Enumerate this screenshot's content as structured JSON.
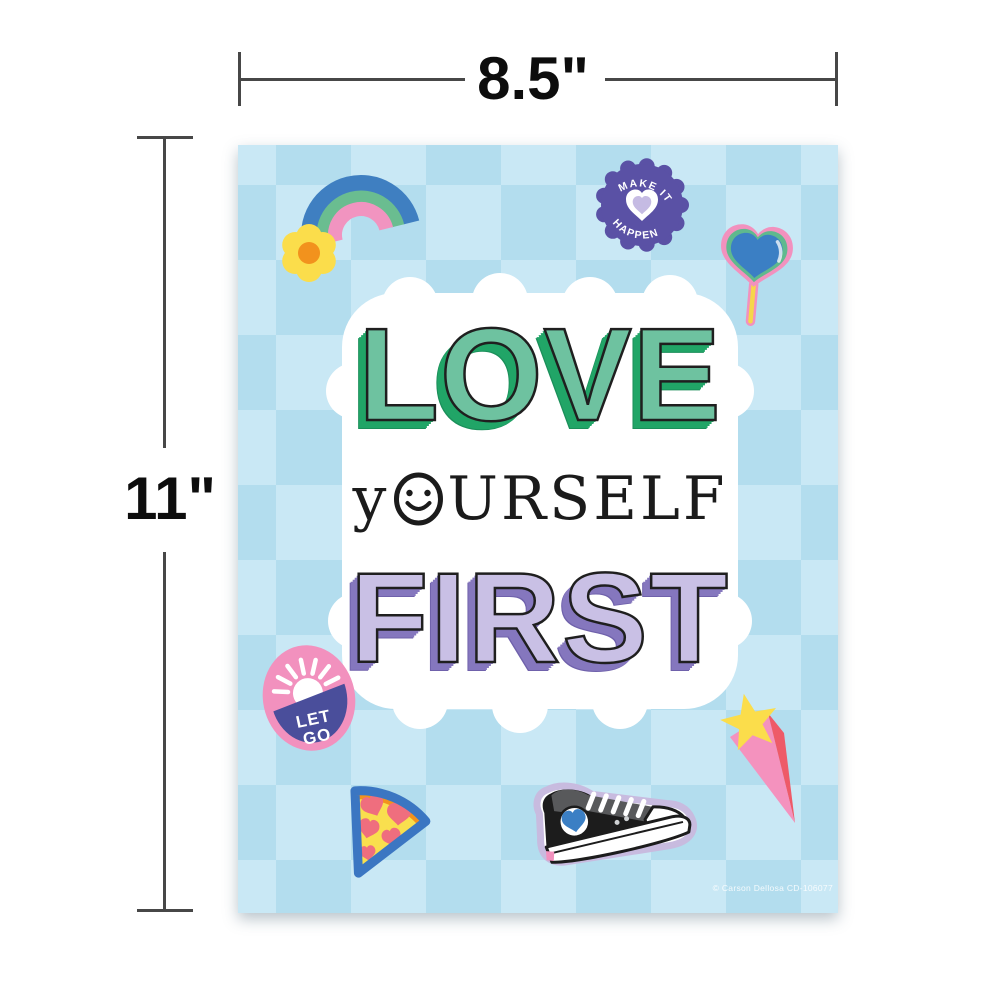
{
  "annotations": {
    "width_label": "8.5\"",
    "height_label": "11\""
  },
  "poster": {
    "background": {
      "checker_light": "#c9e8f5",
      "checker_dark": "#b3ddee"
    },
    "title": {
      "line1": "LOVE",
      "line2_first_letter": "y",
      "line2_rest": "urself",
      "line2_word": "yourself",
      "line3": "FIRST",
      "line1_face_color": "#6ec2a0",
      "line1_extrude_color": "#21a567",
      "line3_face_color": "#c9c0e5",
      "line3_extrude_color": "#8577be"
    },
    "badges": {
      "make_it_happen": {
        "top_text": "MAKE IT",
        "bottom_text": "HAPPEN",
        "color": "#5a51a5",
        "heart_color": "#c5bbe3"
      },
      "let_go": {
        "line1": "LET",
        "line2": "GO",
        "oval_color": "#f291be",
        "banner_color": "#4a4e9b"
      }
    },
    "sticker_icons": [
      "rainbow-flower-sticker",
      "make-it-happen-badge",
      "heart-lollipop-sticker",
      "let-go-badge",
      "pizza-slice-sticker",
      "sneaker-sticker",
      "shooting-star-sticker"
    ],
    "accent_colors": {
      "rainbow_blue": "#3f7fc1",
      "rainbow_green": "#6abd90",
      "rainbow_pink": "#f194c0",
      "flower_yellow": "#fbdd4b",
      "flower_orange": "#f2921d",
      "pizza_outline_blue": "#3b76c2",
      "pizza_cheese": "#f9df4e",
      "pizza_crust": "#f2921d",
      "pepperoni": "#ef6e7e",
      "sneaker_outline": "#c8bbdf",
      "sneaker_gray": "#58595b",
      "heart_blue": "#3b7fc4",
      "star_yellow": "#fbdd4b",
      "star_tail_pink": "#f492be",
      "star_tail_red": "#ee5a68"
    },
    "copyright": "© Carson Dellosa CD-106077"
  }
}
